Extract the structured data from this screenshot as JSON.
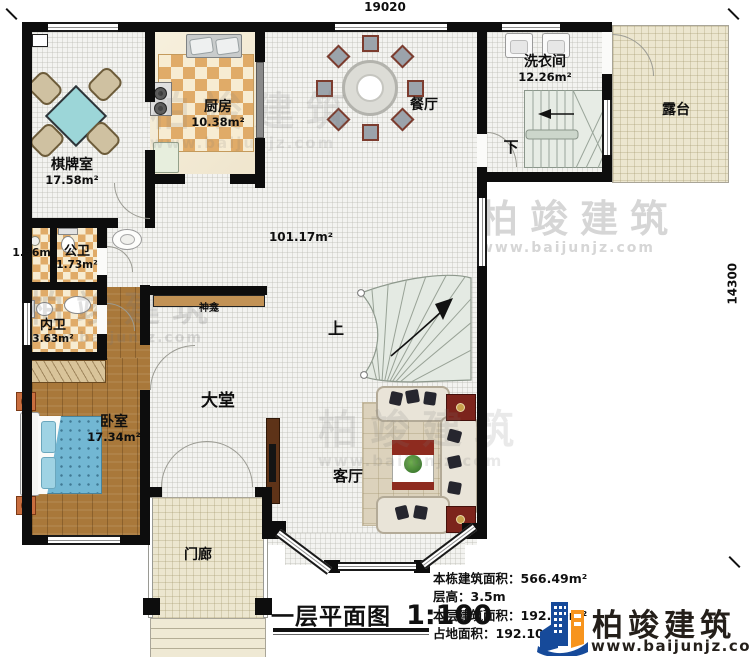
{
  "plan": {
    "dim_width": "19020",
    "dim_height": "14300",
    "hall_area": "101.17m²",
    "rooms": {
      "chess": {
        "name": "棋牌室",
        "area": "17.58m²"
      },
      "kitchen": {
        "name": "厨房",
        "area": "10.38m²"
      },
      "dining": {
        "name": "餐厅"
      },
      "laundry": {
        "name": "洗衣间",
        "area": "12.26m²"
      },
      "terrace": {
        "name": "露台"
      },
      "closet": {
        "area": "1.56m²"
      },
      "public_wc": {
        "name": "公卫",
        "area": "1.73m²"
      },
      "private_wc": {
        "name": "内卫",
        "area": "3.63m²"
      },
      "bedroom": {
        "name": "卧室",
        "area": "17.34m²"
      },
      "lobby": {
        "name": "大堂"
      },
      "living": {
        "name": "客厅"
      },
      "porch": {
        "name": "门廊"
      },
      "shrine": {
        "name": "神龛"
      }
    },
    "stairs": {
      "up": "上",
      "down": "下"
    }
  },
  "titleblock": {
    "title": "一层平面图",
    "scale": "1:100",
    "stats": [
      {
        "label": "本栋建筑面积：",
        "value": "566.49m²"
      },
      {
        "label": "层高：",
        "value": "3.5m"
      },
      {
        "label": "本层建筑面积：",
        "value": "192.10m²"
      },
      {
        "label": "占地面积：",
        "value": "192.10m²"
      }
    ]
  },
  "branding": {
    "name": "柏竣建筑",
    "website": "www.baijunjz.com"
  },
  "watermark": {
    "name": "柏竣建筑",
    "website": "www.baijunjz.com"
  }
}
